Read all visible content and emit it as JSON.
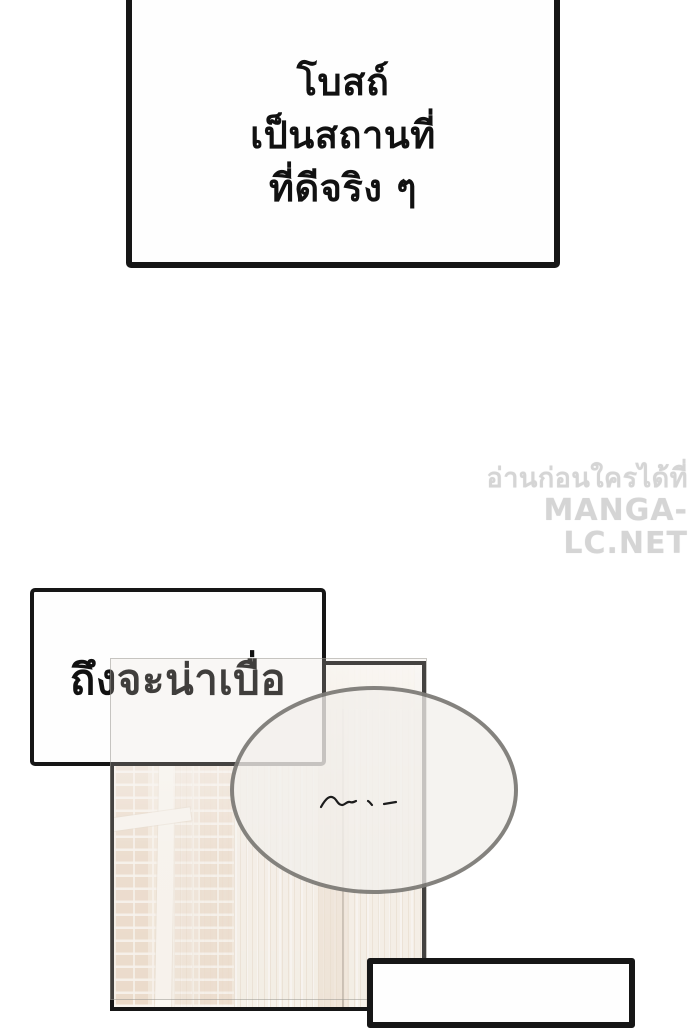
{
  "page": {
    "type": "manga-page",
    "background": "#ffffff"
  },
  "bubbles": {
    "top": {
      "line1": "โบสถ์",
      "line2": "เป็นสถานที่",
      "line3": "ที่ดีจริง ๆ"
    },
    "middle": {
      "text": "ถึงจะน่าเบื่อ"
    },
    "bottom": {
      "text": ""
    }
  },
  "watermark": {
    "line1": "อ่านก่อนใครได้ที่",
    "line2": "MANGA-LC.NET",
    "color": "#d5d5d5"
  },
  "artwork": {
    "panel_description": "pale brick wall with white pillar and striped door, washed in white",
    "thought_mark": "handwritten-squiggle"
  },
  "colors": {
    "outline_black": "#161616",
    "bubble_fill": "#fefefe",
    "ellipse_stroke": "#686562",
    "brick": "#ecd9c5",
    "mortar": "#f8f2ea",
    "door": "#f5eee4",
    "watermark_gray": "#d5d5d5"
  }
}
